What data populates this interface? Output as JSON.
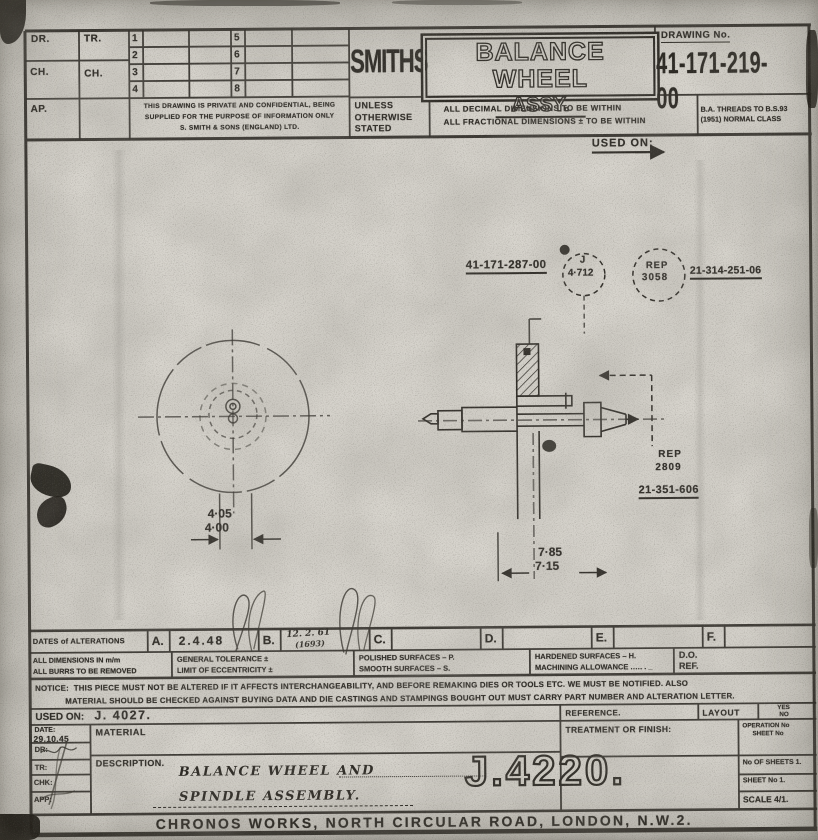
{
  "palette": {
    "paper": "#d7d4cd",
    "ink": "#2b2823"
  },
  "header": {
    "brand": "SMITHS",
    "title_line1": "BALANCE WHEEL",
    "title_line2": "ASSY.",
    "drawing_no_label": "DRAWING No.",
    "drawing_no": "41-171-219-00",
    "dr": "DR.",
    "tr": "TR.",
    "ch_left": "CH.",
    "ch_mid": "CH.",
    "ap": "AP.",
    "rev_nums": [
      "1",
      "2",
      "3",
      "4",
      "5",
      "6",
      "7",
      "8"
    ],
    "confidential_1": "THIS DRAWING IS PRIVATE AND CONFIDENTIAL, BEING",
    "confidential_2": "SUPPLIED FOR THE PURPOSE OF INFORMATION ONLY",
    "confidential_3": "S. SMITH & SONS (ENGLAND) LTD.",
    "unless_1": "UNLESS",
    "unless_2": "OTHERWISE",
    "unless_3": "STATED",
    "decimal_note": "ALL DECIMAL DIMENSIONS TO BE WITHIN",
    "fractional_note": "ALL FRACTIONAL DIMENSIONS ± TO BE WITHIN",
    "ba_note_1": "B.A. THREADS TO B.S.93",
    "ba_note_2": "(1951)   NORMAL   CLASS",
    "used_on": "USED ON:"
  },
  "drawing": {
    "part_top": "41-171-287-00",
    "balloon_letter": "J",
    "balloon_value": "4·712",
    "rep1_line1": "REP",
    "rep1_line2": "3058",
    "part_right_top": "21-314-251-06",
    "rep2_line1": "REP",
    "rep2_line2": "2809",
    "part_right_low": "21-351-606",
    "dim_hub_hi": "4·05",
    "dim_hub_lo": "4·00",
    "dim_len_hi": "7·85",
    "dim_len_lo": "7·15"
  },
  "title_block": {
    "dates_label": "DATES of ALTERATIONS",
    "alterations": [
      {
        "letter": "A.",
        "value": "2.4.48"
      },
      {
        "letter": "B.",
        "value": "12. 2. 61",
        "value2": "(1693)"
      },
      {
        "letter": "C.",
        "value": ""
      },
      {
        "letter": "D.",
        "value": ""
      },
      {
        "letter": "E.",
        "value": ""
      },
      {
        "letter": "F.",
        "value": ""
      }
    ],
    "dims_mm": "ALL DIMENSIONS IN m/m",
    "burrs": "ALL BURRS TO BE REMOVED",
    "general_tol": "GENERAL TOLERANCE  ±",
    "eccentricity": "LIMIT OF ECCENTRICITY ±",
    "polished": "POLISHED SURFACES – P.",
    "smooth": "SMOOTH SURFACES – S.",
    "hardened": "HARDENED SURFACES – H.",
    "machining": "MACHINING ALLOWANCE .…. . _",
    "do_ref_1": "D.O.",
    "do_ref_2": "REF.",
    "notice_label": "NOTICE:",
    "notice_1": "THIS PIECE MUST NOT BE ALTERED IF IT AFFECTS INTERCHANGEABILITY, AND BEFORE REMAKING DIES OR TOOLS ETC. WE MUST BE NOTIFIED. ALSO",
    "notice_2": "MATERIAL SHOULD BE CHECKED AGAINST BUYING DATA AND DIE CASTINGS AND STAMPINGS BOUGHT OUT MUST CARRY PART NUMBER AND ALTERATION LETTER.",
    "used_on_label": "USED ON:",
    "used_on_value": "J. 4027.",
    "reference_label": "REFERENCE.",
    "layout_label": "LAYOUT",
    "layout_yes": "YES",
    "layout_no": "NO",
    "date_label": "DATE:",
    "date_value": "29.10.45",
    "dr_label": "DR:",
    "tr_label": "TR:",
    "chk_label": "CHK:",
    "app_label": "APP:",
    "material_label": "MATERIAL",
    "description_label": "DESCRIPTION.",
    "description_line1": "BALANCE WHEEL AND",
    "description_line2": "SPINDLE ASSEMBLY.",
    "treatment_label": "TREATMENT OR FINISH:",
    "operation_1": "OPERATION No",
    "operation_2": "SHEET No",
    "job_number": "J.4220.",
    "sheets_label": "No OF SHEETS 1.",
    "sheet_no_label": "SHEET No 1.",
    "scale_label": "SCALE 4/1.",
    "footer": "CHRONOS WORKS,   NORTH CIRCULAR ROAD,   LONDON, N.W.2."
  }
}
